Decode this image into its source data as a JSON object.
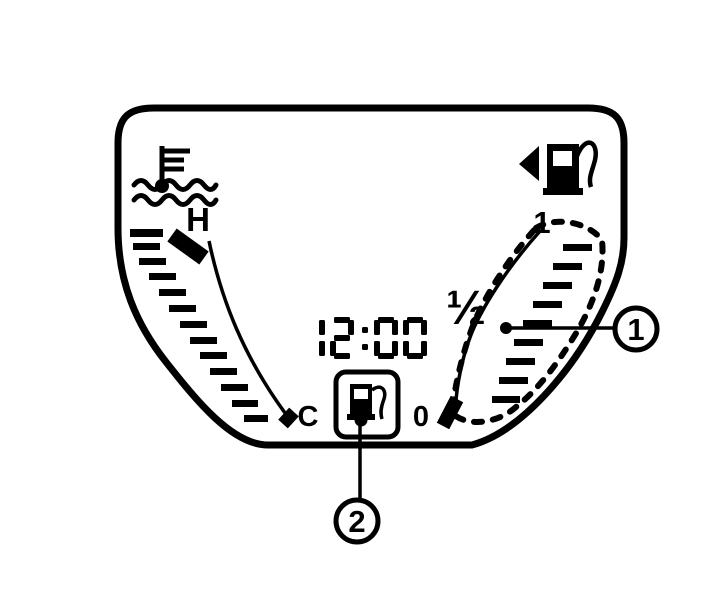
{
  "colors": {
    "ink": "#000000",
    "background": "#ffffff"
  },
  "display": {
    "clock": "12:00",
    "temperature_gauge": {
      "high_label": "H",
      "low_label": "C",
      "icon": "coolant-temperature-icon"
    },
    "fuel_gauge": {
      "full_label": "1",
      "half_label": "½",
      "empty_label": "0",
      "icon": "fuel-pump-icon-with-left-arrow"
    },
    "low_fuel_warning": {
      "icon": "fuel-pump-icon"
    }
  },
  "callouts": {
    "one": "1",
    "two": "2"
  }
}
